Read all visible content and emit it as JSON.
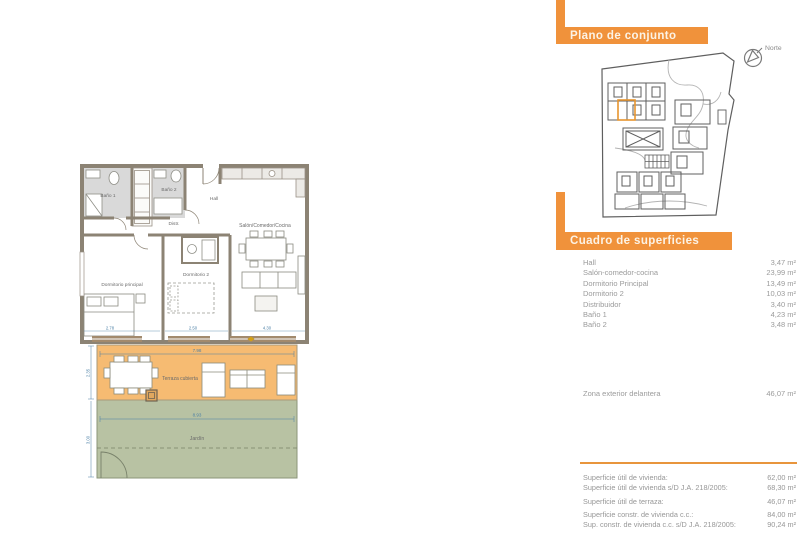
{
  "page": {
    "background": "#ffffff"
  },
  "right_panel": {
    "accent_color": "#f0923b",
    "line_color": "#e8953c",
    "section1": {
      "title": "Plano de conjunto"
    },
    "north": {
      "label": "Norte"
    },
    "section2": {
      "title": "Cuadro de superficies"
    },
    "surfaces": [
      {
        "label": "Hall",
        "value": "3,47 m²"
      },
      {
        "label": "Salón-comedor-cocina",
        "value": "23,99 m²"
      },
      {
        "label": "Dormitorio Principal",
        "value": "13,49 m²"
      },
      {
        "label": "Dormitorio 2",
        "value": "10,03 m²"
      },
      {
        "label": "Distribuidor",
        "value": "3,40 m²"
      },
      {
        "label": "Baño 1",
        "value": "4,23 m²"
      },
      {
        "label": "Baño 2",
        "value": "3,48 m²"
      }
    ],
    "exterior": {
      "label": "Zona exterior delantera",
      "value": "46,07 m²"
    },
    "summary": [
      {
        "label": "Superficie útil de vivienda:",
        "value": "62,00 m²"
      },
      {
        "label": "Superficie útil de vivienda s/D J.A. 218/2005:",
        "value": "68,30 m²"
      },
      {
        "label": "Superficie útil de terraza:",
        "value": "46,07 m²"
      },
      {
        "label": "Superficie constr. de vivienda c.c.:",
        "value": "84,00 m²"
      },
      {
        "label": "Sup. constr. de vivienda c.c. s/D J.A. 218/2005:",
        "value": "90,24 m²"
      }
    ]
  },
  "floor_plan": {
    "colors": {
      "terrace_fill": "#f6bb72",
      "garden_fill": "#b8c2a3",
      "wall": "#8c8374",
      "highlight_unit": "#e8952e"
    },
    "rooms": {
      "bano1": "Baño 1",
      "bano2": "Baño 2",
      "hall": "Hall",
      "distr": "Distr.",
      "salon": "Salón/Comedor/Cocina",
      "dorm_ppal": "Dormitorio principal",
      "dorm2": "Dormitorio 2",
      "terraza": "Terraza cubierta",
      "jardin": "Jardín"
    },
    "dims": {
      "dorm_ppal_w": "2.78",
      "dorm2_w": "2.50",
      "salon_w": "4.30",
      "terraza_w": "7.98",
      "jardin_w": "8.93",
      "terraza_h": "2.35",
      "jardin_h": "3.00"
    }
  }
}
